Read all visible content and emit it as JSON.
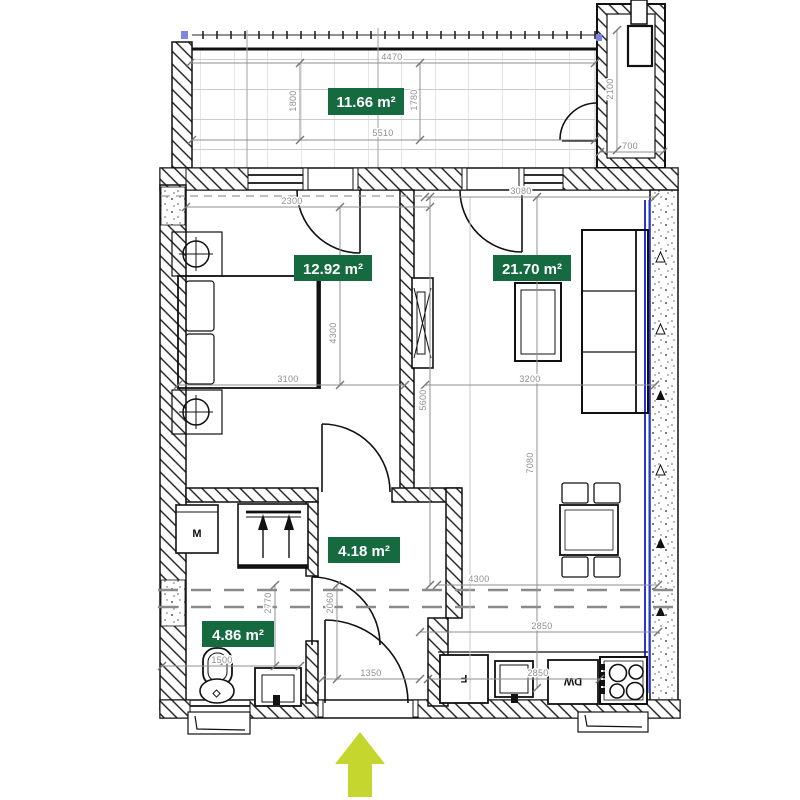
{
  "rooms": {
    "balcony": {
      "area": "11.66 m²"
    },
    "bedroom": {
      "area": "12.92 m²"
    },
    "living": {
      "area": "21.70 m²"
    },
    "hall": {
      "area": "4.18 m²"
    },
    "bath": {
      "area": "4.86 m²"
    }
  },
  "dims": {
    "balcony_top": "4470",
    "balcony_inner": "5510",
    "balcony_left": "1800",
    "balcony_right": "1780",
    "shaft_h": "2100",
    "shaft_w": "700",
    "living_top": "3080",
    "bedroom_top": "2300",
    "bedroom_w": "3100",
    "bedroom_h": "4300",
    "living_w": "3200",
    "core_h": "5600",
    "living_h": "7080",
    "bath_h": "2770",
    "hall_h": "2060",
    "bath_w": "1500",
    "entry_w": "1350",
    "kitchen_span": "4300",
    "kitchen_a": "2850",
    "kitchen_b": "2850"
  },
  "appliances": {
    "washer": "M",
    "fridge": "F",
    "dishwasher": "DW"
  },
  "colors": {
    "room_label_bg": "#156a40",
    "room_label_text": "#ffffff",
    "window_glazing": "#2a35d6",
    "entrance_arrow": "#c5d62e",
    "dimension_text": "#8f8f8f",
    "window_marker": "#7b86e0"
  }
}
